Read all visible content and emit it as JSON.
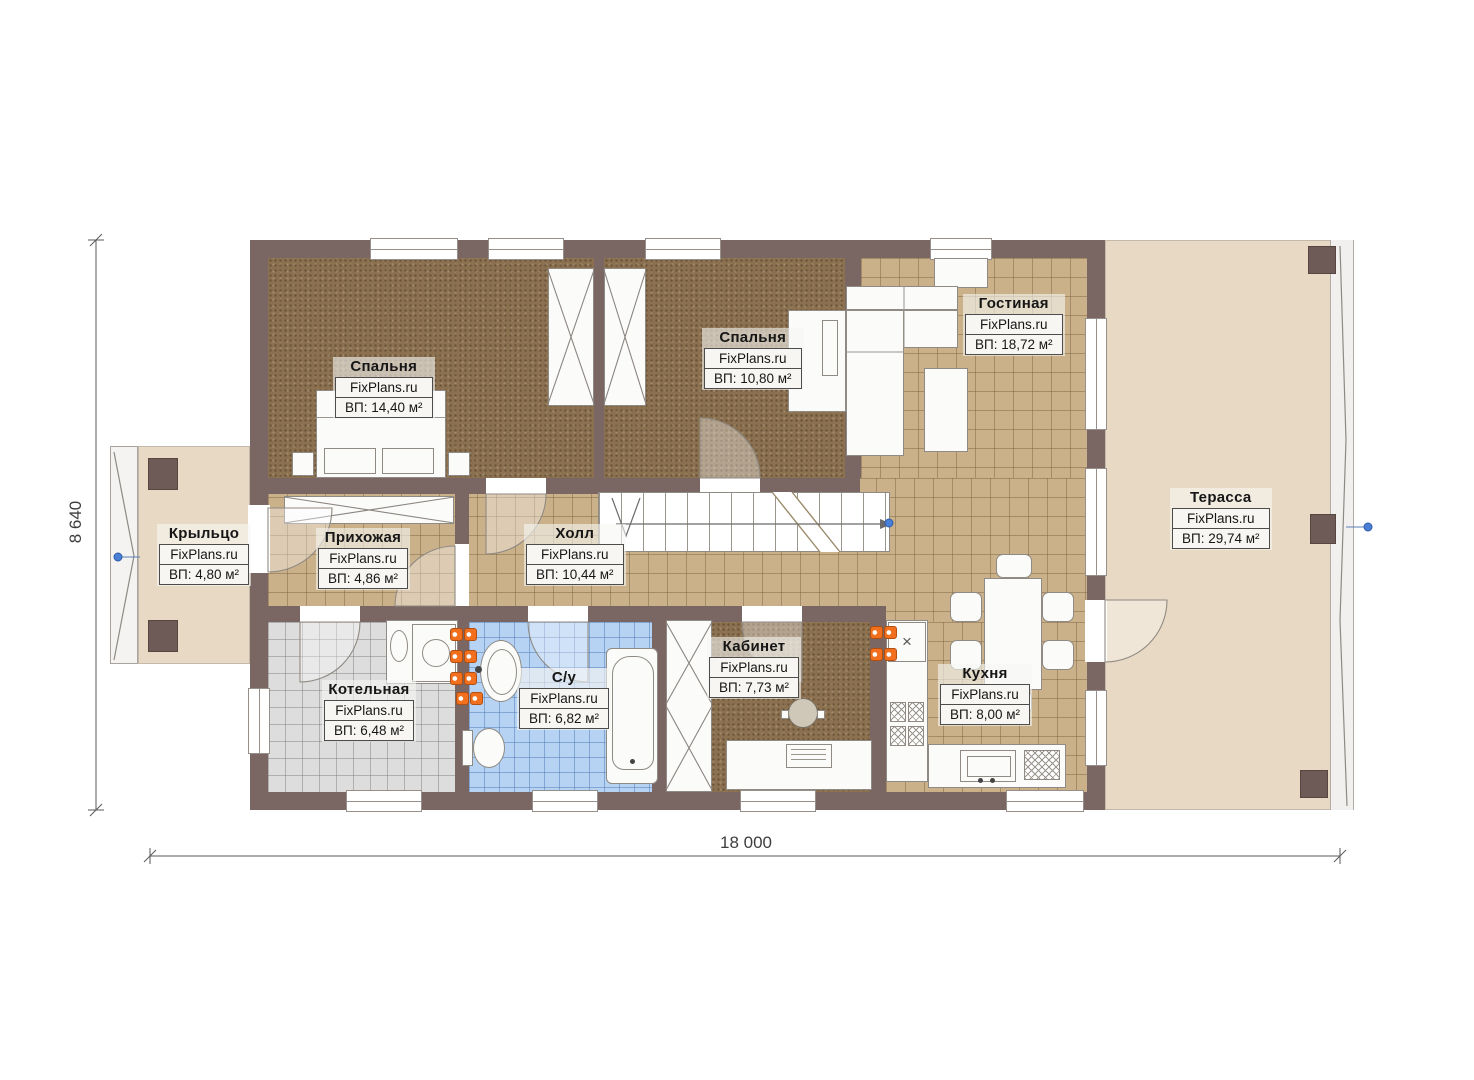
{
  "brand": "FixPlans.ru",
  "dimensions": {
    "width": "18 000",
    "height": "8 640"
  },
  "rooms": {
    "bedroom1": {
      "name": "Спальня",
      "area": "ВП: 14,40 м²"
    },
    "bedroom2": {
      "name": "Спальня",
      "area": "ВП: 10,80 м²"
    },
    "living": {
      "name": "Гостиная",
      "area": "ВП: 18,72 м²"
    },
    "porch": {
      "name": "Крыльцо",
      "area": "ВП: 4,80 м²"
    },
    "entry": {
      "name": "Прихожая",
      "area": "ВП: 4,86 м²"
    },
    "hall": {
      "name": "Холл",
      "area": "ВП: 10,44 м²"
    },
    "terrace": {
      "name": "Терасса",
      "area": "ВП: 29,74 м²"
    },
    "boiler": {
      "name": "Котельная",
      "area": "ВП: 6,48 м²"
    },
    "bathroom": {
      "name": "С/у",
      "area": "ВП: 6,82 м²"
    },
    "office": {
      "name": "Кабинет",
      "area": "ВП: 7,73 м²"
    },
    "kitchen": {
      "name": "Кухня",
      "area": "ВП: 8,00 м²"
    }
  },
  "colors": {
    "wall": "#7a6763",
    "tile_tan": "#cbb18a",
    "tile_gray": "#dddddd",
    "tile_blue": "#b7d3f3",
    "carpet": "#8b7150",
    "terrace": "#e8d9c4",
    "socket_orange": "#f2701d",
    "marker_blue": "#4a7fd6"
  }
}
